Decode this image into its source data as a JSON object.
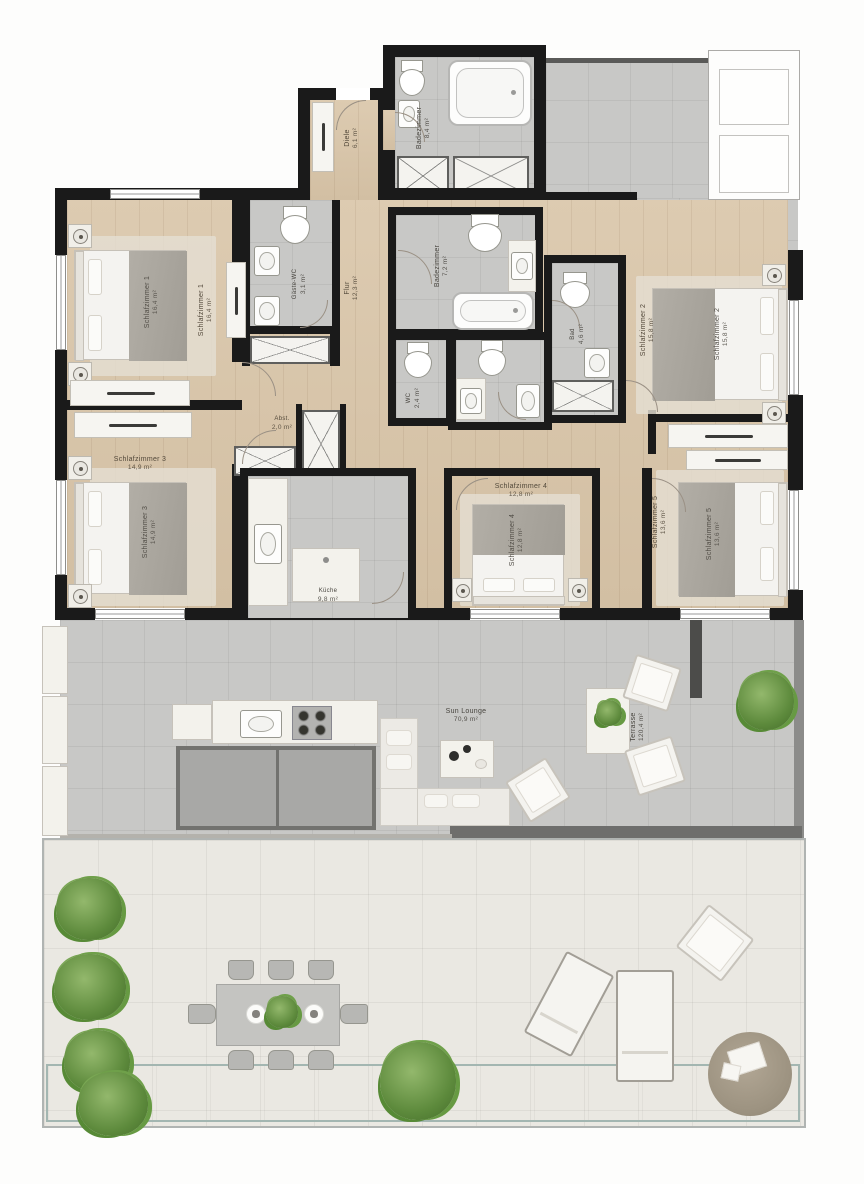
{
  "colors": {
    "wall": "#1a1a1a",
    "wood_floor": "#d9c5a8",
    "bath_tile": "#c8c8c6",
    "terrace_tile": "#eae8e2",
    "pool_water": "#cdddd8",
    "plant_green": "#5d8a3c",
    "blanket_gray": "#a9a49c"
  },
  "rooms": {
    "hall": {
      "name": "Diele",
      "area": "6,1 m²"
    },
    "corridor": {
      "name": "Flur",
      "area": "12,3 m²"
    },
    "bath_top": {
      "name": "Badezimmer",
      "area": "8,4 m²"
    },
    "bath_master": {
      "name": "Badezimmer",
      "area": "7,2 m²"
    },
    "guest_wc": {
      "name": "Gäste-WC",
      "area": "3,1 m²"
    },
    "wc_small": {
      "name": "WC",
      "area": "2,4 m²"
    },
    "bath_right": {
      "name": "Bad",
      "area": "4,6 m²"
    },
    "storage": {
      "name": "Abst.",
      "area": "2,0 m²"
    },
    "bedroom_1": {
      "name": "Schlafzimmer 1",
      "area": "16,4 m²"
    },
    "bedroom_2": {
      "name": "Schlafzimmer 2",
      "area": "15,8 m²"
    },
    "bedroom_3": {
      "name": "Schlafzimmer 3",
      "area": "14,9 m²"
    },
    "bedroom_4": {
      "name": "Schlafzimmer 4",
      "area": "12,8 m²"
    },
    "bedroom_5": {
      "name": "Schlafzimmer 5",
      "area": "13,6 m²"
    },
    "kitchen": {
      "name": "Küche",
      "area": "9,8 m²"
    },
    "sun_lounge": {
      "name": "Sun Lounge",
      "area": "70,9 m²"
    },
    "terrace": {
      "name": "Terrasse",
      "area": "120,4 m²"
    }
  }
}
